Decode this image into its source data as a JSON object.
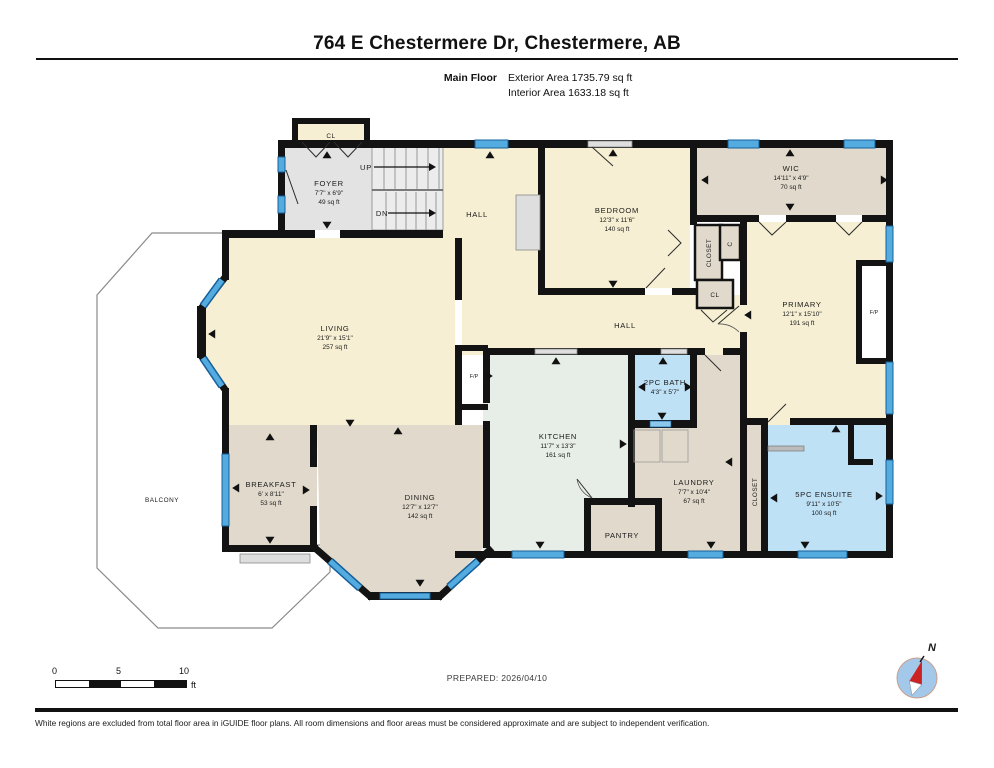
{
  "header": {
    "title": "764 E Chestermere Dr, Chestermere, AB",
    "floor_label": "Main Floor",
    "exterior_area": "Exterior Area 1735.79 sq ft",
    "interior_area": "Interior Area 1633.18 sq ft"
  },
  "rooms": {
    "foyer": {
      "name": "FOYER",
      "dims": "7'7\" x 6'9\"",
      "area": "49 sq ft"
    },
    "hall_upper": {
      "name": "HALL"
    },
    "hall_lower": {
      "name": "HALL"
    },
    "bedroom": {
      "name": "BEDROOM",
      "dims": "12'3\" x 11'6\"",
      "area": "140 sq ft"
    },
    "wic": {
      "name": "WIC",
      "dims": "14'11\" x 4'9\"",
      "area": "70 sq ft"
    },
    "primary": {
      "name": "PRIMARY",
      "dims": "12'1\" x 15'10\"",
      "area": "191 sq ft"
    },
    "living": {
      "name": "LIVING",
      "dims": "21'9\" x 15'1\"",
      "area": "257 sq ft"
    },
    "bath_2pc": {
      "name": "2PC BATH",
      "dims": "4'3\" x 5'7\""
    },
    "kitchen": {
      "name": "KITCHEN",
      "dims": "11'7\" x 13'3\"",
      "area": "161 sq ft"
    },
    "breakfast": {
      "name": "BREAKFAST",
      "dims": "6' x 8'11\"",
      "area": "53 sq ft"
    },
    "dining": {
      "name": "DINING",
      "dims": "12'7\" x 12'7\"",
      "area": "142 sq ft"
    },
    "laundry": {
      "name": "LAUNDRY",
      "dims": "7'7\" x 10'4\"",
      "area": "67 sq ft"
    },
    "pantry": {
      "name": "PANTRY"
    },
    "ensuite": {
      "name": "5PC ENSUITE",
      "dims": "9'11\" x 10'5\"",
      "area": "100 sq ft"
    },
    "balcony": {
      "name": "BALCONY"
    },
    "closet_bedroom": {
      "name": "CLOSET"
    },
    "closet_ensuite": {
      "name": "CLOSET"
    },
    "closet_small": {
      "name": "C"
    },
    "cl_entry": {
      "name": "CL"
    },
    "cl_hall": {
      "name": "CL"
    },
    "fireplace_living": {
      "name": "F/P"
    },
    "fireplace_primary": {
      "name": "F/P"
    },
    "stairs": {
      "up": "UP",
      "dn": "DN"
    }
  },
  "footer": {
    "prepared": "PREPARED: 2026/04/10",
    "disclaimer": "White regions are excluded from total floor area in iGUIDE floor plans. All room dimensions and floor areas must be considered approximate and are subject to independent verification.",
    "scale": {
      "t0": "0",
      "t5": "5",
      "t10": "10",
      "unit": "ft"
    },
    "compass": {
      "north": "N"
    }
  },
  "colors": {
    "wall": "#131313",
    "window_blue": "#53ABDF",
    "window_edge": "#15609B",
    "room_cream": "#F6EFD3",
    "room_tan": "#E1DACC",
    "room_gray": "#E3E3E3",
    "room_mint": "#E6EEE7",
    "room_blue": "#BFE1F5",
    "compass_red": "#CC2222"
  }
}
